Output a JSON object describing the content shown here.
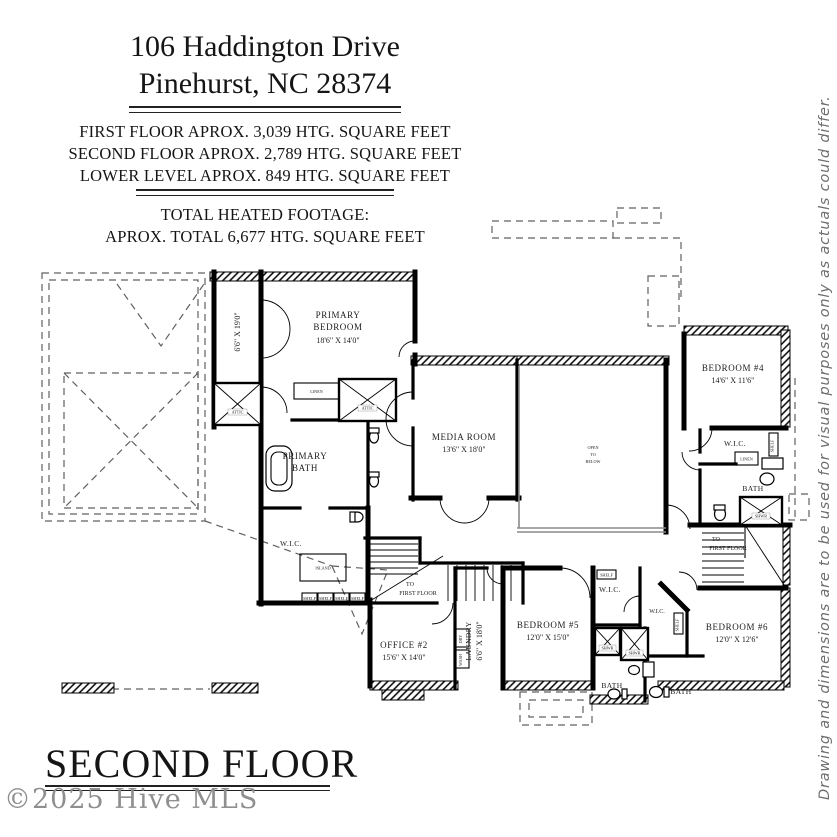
{
  "header": {
    "address_line1": "106 Haddington Drive",
    "address_line2": "Pinehurst, NC 28374",
    "sqft_lines": [
      "FIRST FLOOR APROX. 3,039 HTG. SQUARE FEET",
      "SECOND FLOOR APROX. 2,789 HTG. SQUARE FEET",
      "LOWER LEVEL APROX. 849 HTG. SQUARE FEET"
    ],
    "total_heading": "TOTAL HEATED FOOTAGE:",
    "total_line": "APROX. TOTAL 6,677 HTG. SQUARE FEET"
  },
  "disclaimer": "Drawing and dimensions are to be used for visual purposes only as actuals could differ.",
  "footer": {
    "floor_label": "SECOND FLOOR",
    "watermark": "©2025 Hive MLS"
  },
  "plan": {
    "rooms": {
      "primary_bedroom": {
        "name1": "PRIMARY",
        "name2": "BEDROOM",
        "dim": "18'6\" X 14'0\""
      },
      "primary_bath": {
        "name1": "PRIMARY",
        "name2": "BATH"
      },
      "media_room": {
        "name": "MEDIA ROOM",
        "dim": "13'6\" X 18'0\""
      },
      "bedroom4": {
        "name": "BEDROOM #4",
        "dim": "14'6\" X 11'6\""
      },
      "bedroom5": {
        "name": "BEDROOM #5",
        "dim": "12'0\" X 15'0\""
      },
      "bedroom6": {
        "name": "BEDROOM #6",
        "dim": "12'0\" X 12'6\""
      },
      "office2": {
        "name": "OFFICE #2",
        "dim": "15'6\" X 14'0\""
      },
      "laundry": {
        "name": "LAUNDRY",
        "dim": "6'6\" X 18'0\""
      },
      "balcony_dim": "6'6\" X 19'0\""
    },
    "labels": {
      "wic": "W.I.C.",
      "bath": "BATH",
      "shelf": "SHELF",
      "shwr": "SHWR",
      "linen": "LINEN",
      "attic": "ATTIC",
      "island": "ISLAND",
      "open1": "OPEN",
      "open2": "TO",
      "open3": "BELOW",
      "to": "TO",
      "first_floor": "FIRST FLOOR",
      "dry": "DRY",
      "wash": "WASH"
    },
    "colors": {
      "wall": "#000000",
      "window": "#8a8a8a",
      "dash": "#606060"
    }
  }
}
